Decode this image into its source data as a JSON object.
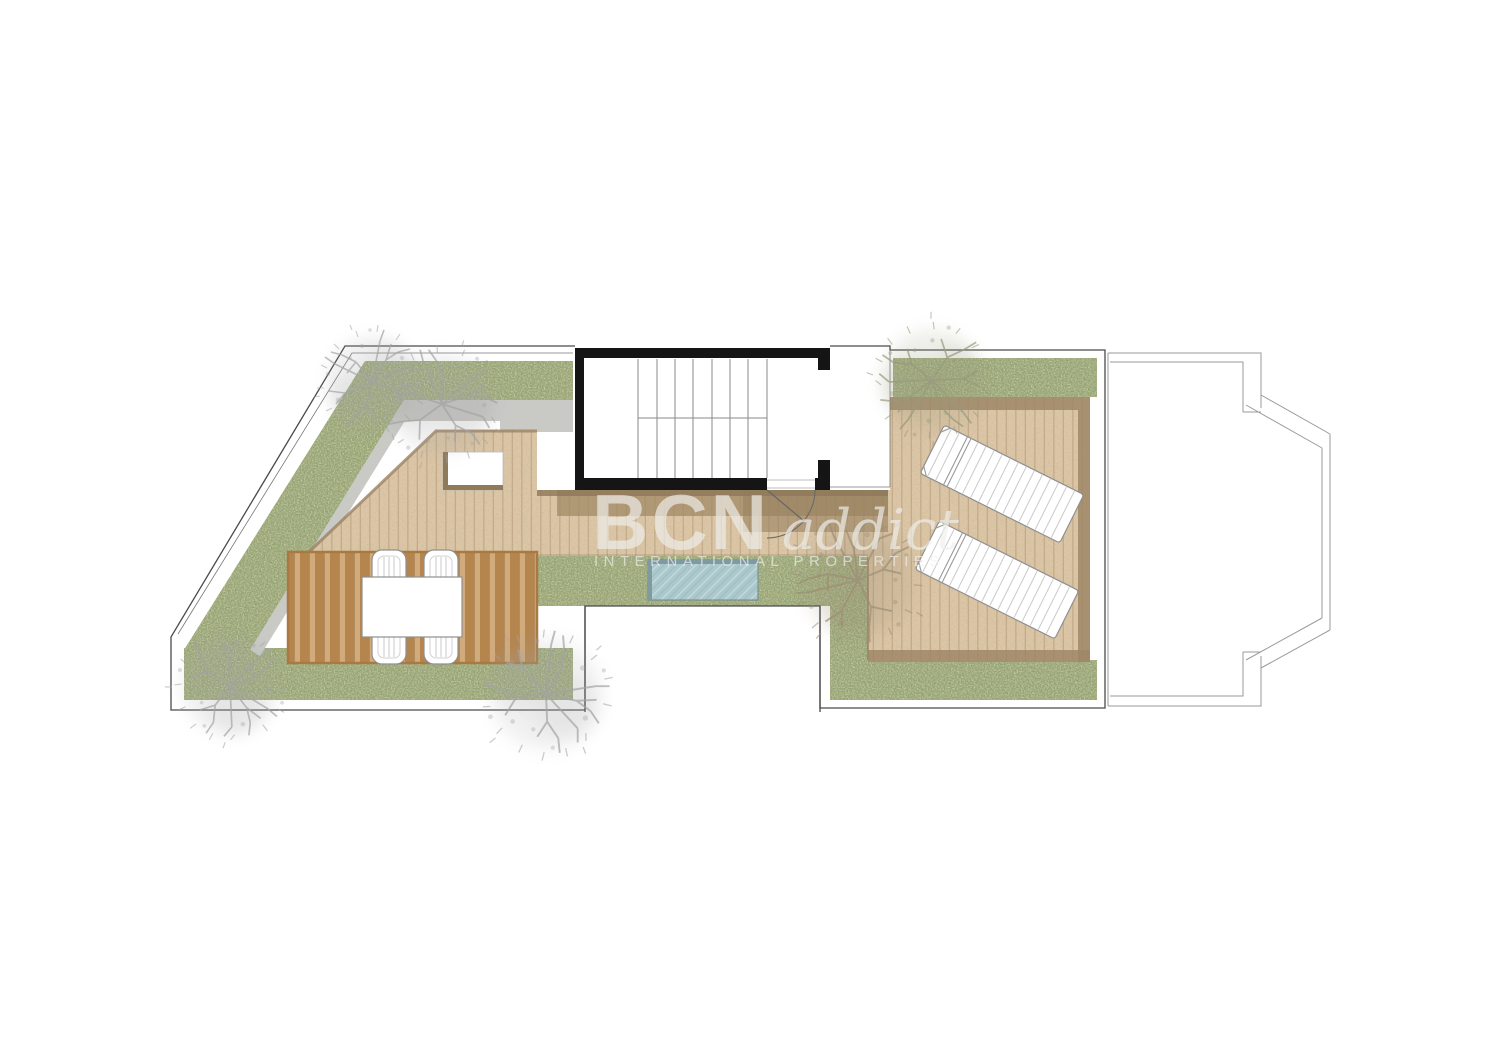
{
  "watermark": {
    "brand": "BCN",
    "brand_script": "addict",
    "tagline": "INTERNATIONAL PROPERTIES"
  },
  "colors": {
    "grass": "#8e9b69",
    "deck": "#dbc6a6",
    "deck-line": "#c4aa88",
    "deck-shadow": "#9b8264",
    "pergola-light": "#d2ab7c",
    "pergola-dark": "#b5854e",
    "pergola-frame": "#a87a42",
    "pool": "#abc8cc",
    "pool-edge": "#7f9aa1",
    "wall": "#151515",
    "outline": "#4a4a4a",
    "shadow-gray": "#c9c9c6",
    "tree-gray": "#a3a3a3",
    "tree-olive": "#99997e",
    "tree-brown": "#9c8d75",
    "watermark": "#efefec"
  },
  "plan": {
    "type": "roof-terrace-floor-plan",
    "furniture": {
      "sun_loungers": 2,
      "dining_chairs": 4,
      "dining_tables": 1
    },
    "features": [
      "green roof borders",
      "wood deck",
      "pergola dining area",
      "plunge pool",
      "staircase core",
      "skylight opening",
      "courtyard void",
      "neighbouring roof with bay"
    ]
  }
}
